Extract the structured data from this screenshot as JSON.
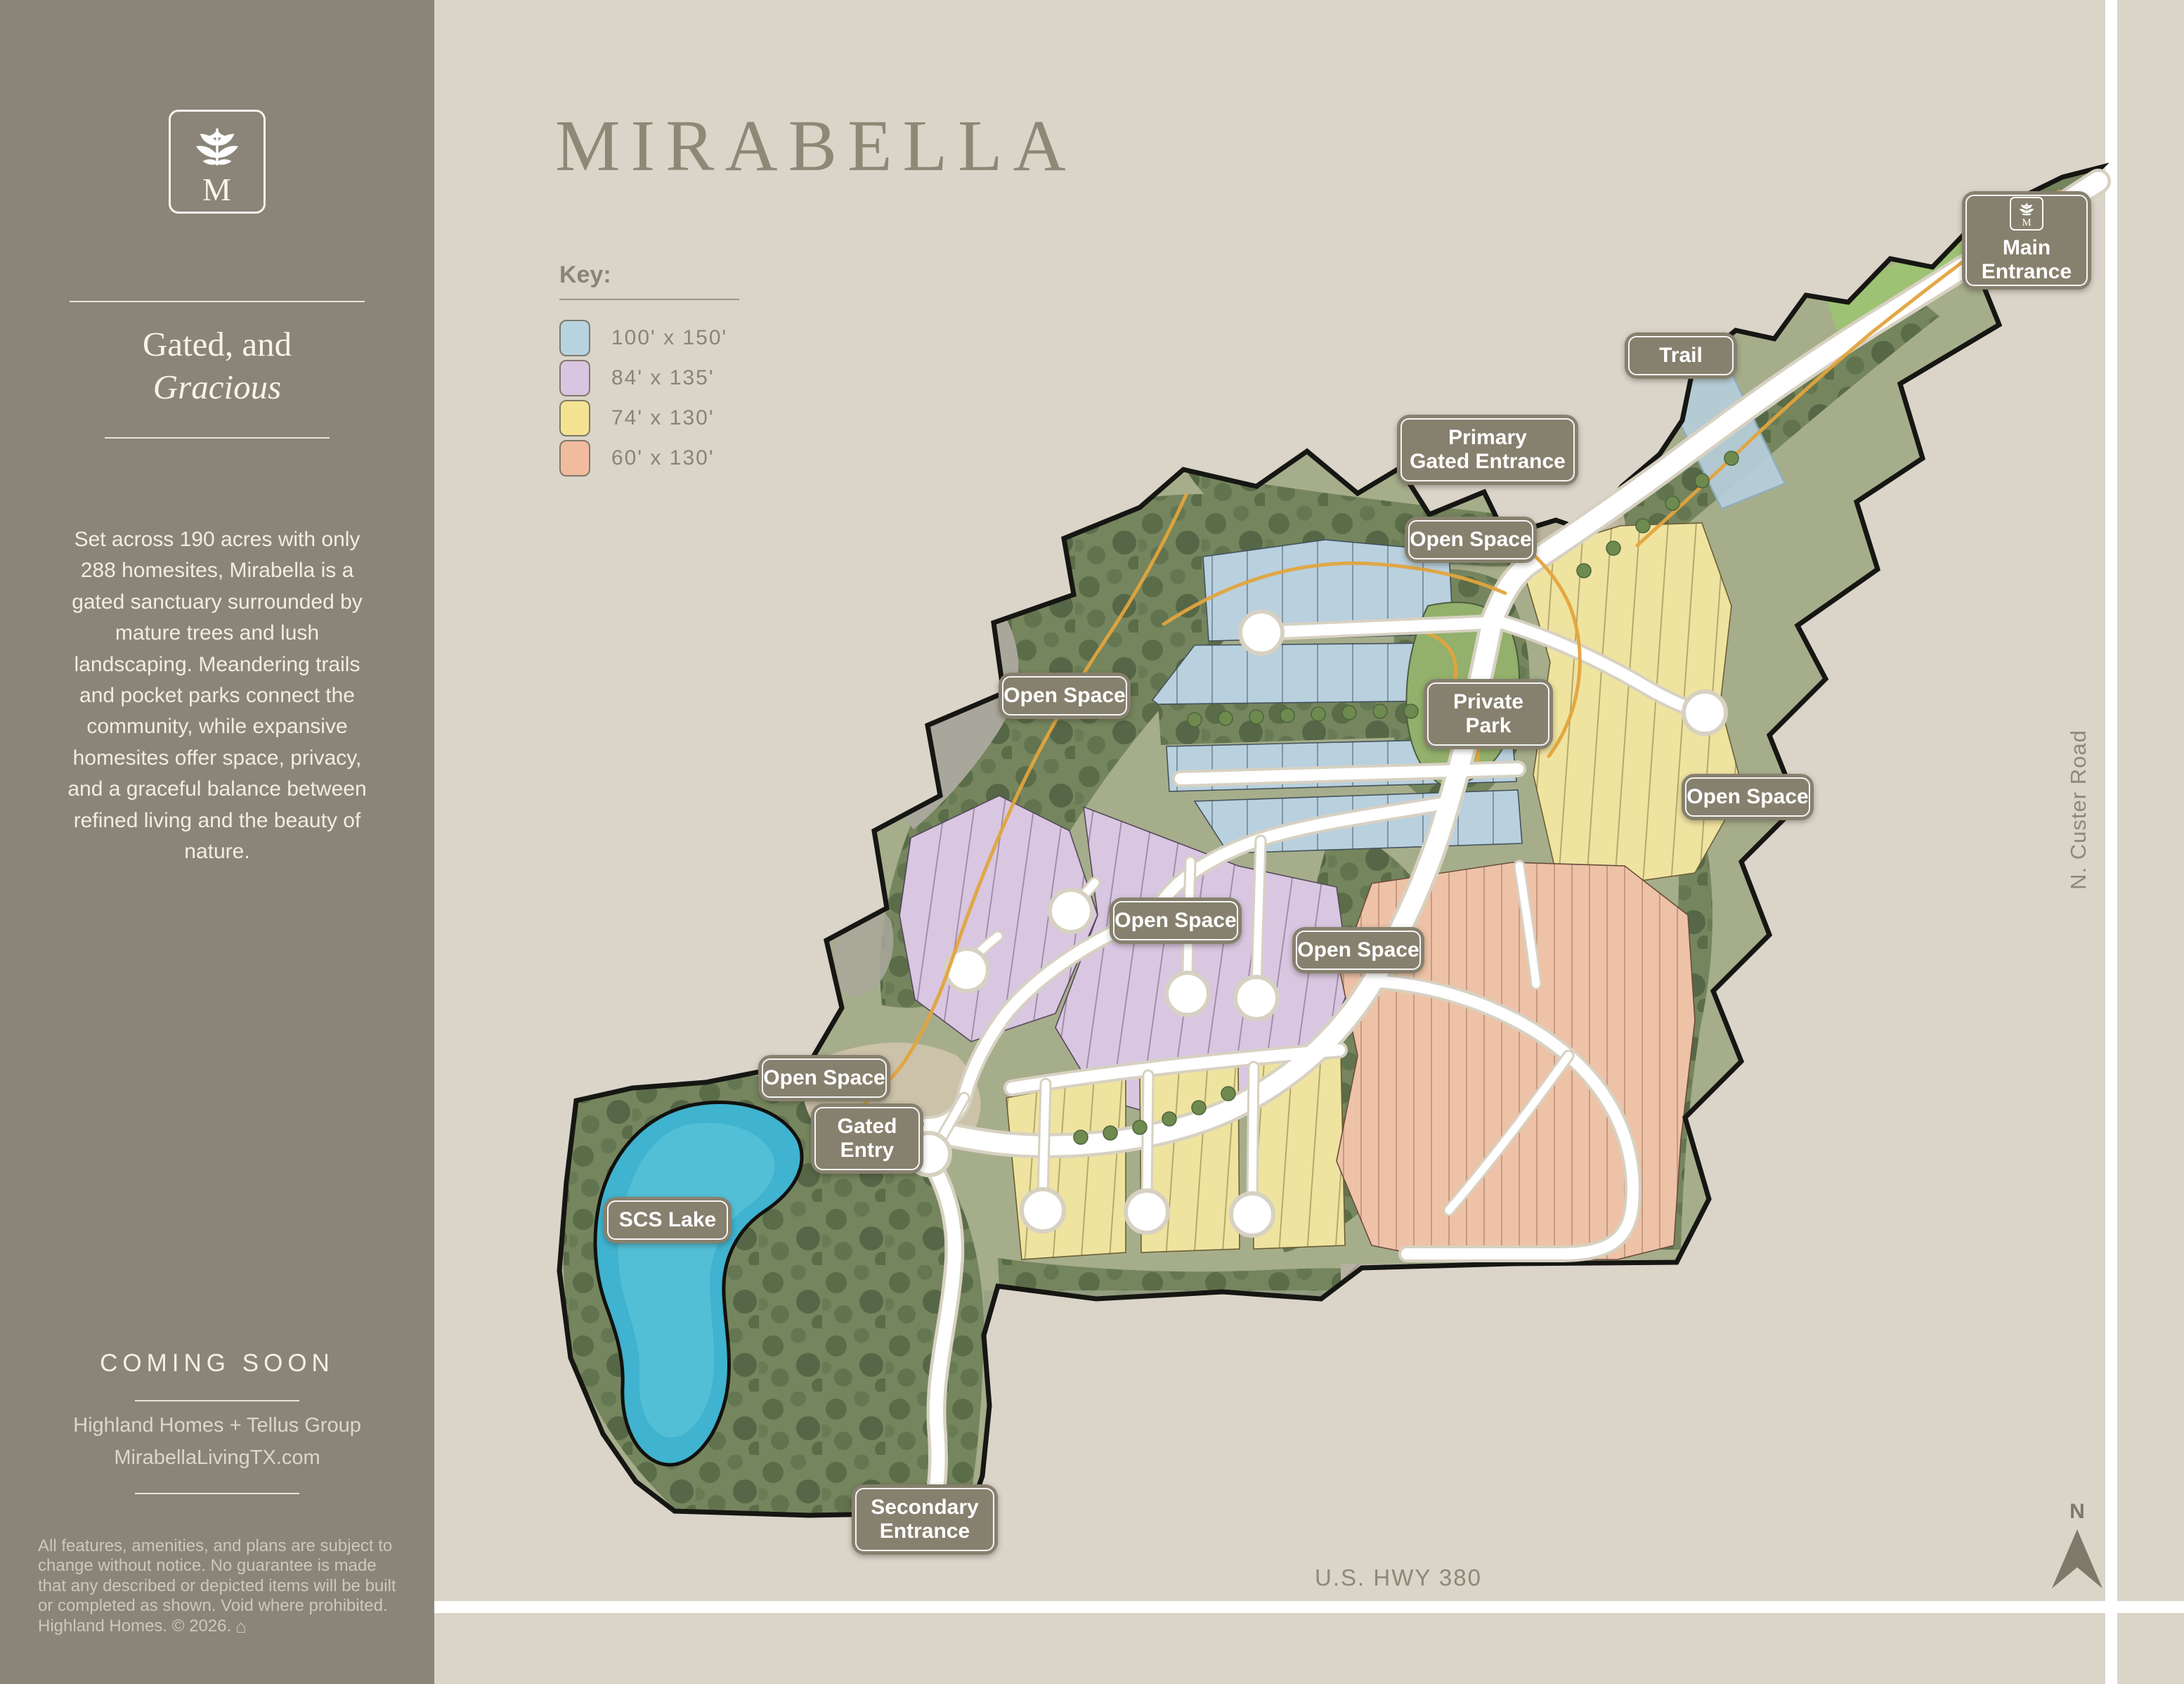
{
  "colors": {
    "sidebar_background": "#8a8578",
    "page_background": "#dbd4c9",
    "badge_background": "#86806e",
    "title_text": "#8e8876"
  },
  "sidebar": {
    "logo": {
      "monogram": "M",
      "icon": "floral-sprig-icon"
    },
    "heading_line1": "Gated, and",
    "heading_line2": "Gracious",
    "description": "Set across 190 acres with only 288 homesites, Mirabella is a gated sanctuary surrounded by mature trees and lush landscaping. Meandering trails and pocket parks connect the community, while expansive homesites offer space, privacy, and a graceful balance between refined living and the beauty of nature.",
    "coming_soon": "COMING SOON",
    "developers": "Highland Homes + Tellus Group",
    "website": "MirabellaLivingTX.com",
    "disclaimer": "All features, amenities, and plans are subject to change without notice. No guarantee is made that any described or depicted items will be built or completed as shown. Void where prohibited. Highland Homes. © 2026.",
    "equal_housing_icon": "equal-housing-icon"
  },
  "main": {
    "title": "MIRABELLA",
    "key": {
      "title": "Key:",
      "items": [
        {
          "color": "#b7d3e0",
          "label": "100'  x  150'"
        },
        {
          "color": "#d9c5e1",
          "label": "84'  x  135'"
        },
        {
          "color": "#f4e392",
          "label": "74'  x  130'"
        },
        {
          "color": "#f1bc9d",
          "label": "60'  x  130'"
        }
      ]
    },
    "roads": {
      "custer": "N. Custer Road",
      "highway": "U.S. HWY 380"
    },
    "compass": "N"
  },
  "map": {
    "badges": [
      {
        "id": "main-entrance",
        "label": "Main\nEntrance"
      },
      {
        "id": "trail",
        "label": "Trail"
      },
      {
        "id": "primary-gated-entrance",
        "label": "Primary\nGated Entrance"
      },
      {
        "id": "open-space-north",
        "label": "Open Space"
      },
      {
        "id": "open-space-west",
        "label": "Open Space"
      },
      {
        "id": "private-park",
        "label": "Private\nPark"
      },
      {
        "id": "open-space-east",
        "label": "Open Space"
      },
      {
        "id": "open-space-central",
        "label": "Open Space"
      },
      {
        "id": "open-space-mid",
        "label": "Open Space"
      },
      {
        "id": "open-space-lake",
        "label": "Open Space"
      },
      {
        "id": "gated-entry",
        "label": "Gated\nEntry"
      },
      {
        "id": "scs-lake",
        "label": "SCS Lake"
      },
      {
        "id": "secondary-entrance",
        "label": "Secondary\nEntrance"
      }
    ],
    "features": [
      "SCS Lake",
      "Private Park",
      "Trail",
      "Open Space"
    ]
  }
}
